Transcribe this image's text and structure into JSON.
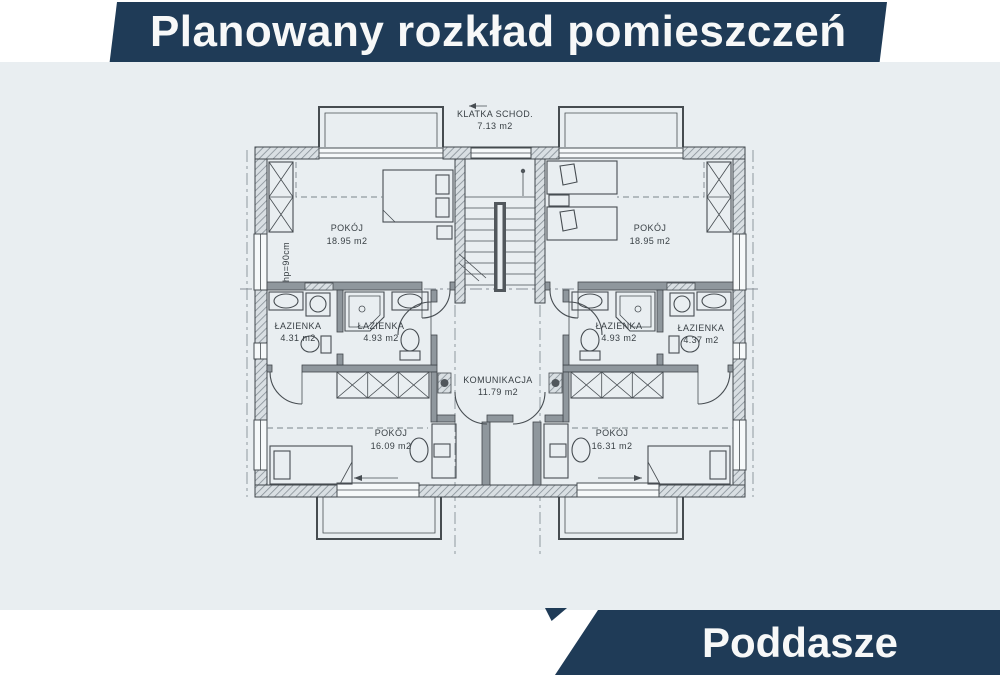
{
  "header": {
    "title": "Planowany rozkład pomieszczeń"
  },
  "footer": {
    "label": "Poddasze"
  },
  "colors": {
    "banner": "#1f3b57",
    "banner_text": "#f7f8f8",
    "paper": "#e9eef1",
    "line": "#40464b"
  },
  "plan": {
    "rooms": [
      {
        "name": "KLATKA SCHOD.",
        "area": "7.13 m2"
      },
      {
        "name": "POKÓJ",
        "area": "18.95 m2"
      },
      {
        "name": "POKÓJ",
        "area": "18.95 m2"
      },
      {
        "name": "ŁAZIENKA",
        "area": "4.31 m2"
      },
      {
        "name": "ŁAZIENKA",
        "area": "4.93 m2"
      },
      {
        "name": "ŁAZIENKA",
        "area": "4.93 m2"
      },
      {
        "name": "ŁAZIENKA",
        "area": "4.37 m2"
      },
      {
        "name": "KOMUNIKACJA",
        "area": "11.79 m2"
      },
      {
        "name": "POKÓJ",
        "area": "16.09 m2"
      },
      {
        "name": "POKÓJ",
        "area": "16.31 m2"
      }
    ],
    "annotations": {
      "knee_wall_height": "hp=90cm"
    }
  }
}
